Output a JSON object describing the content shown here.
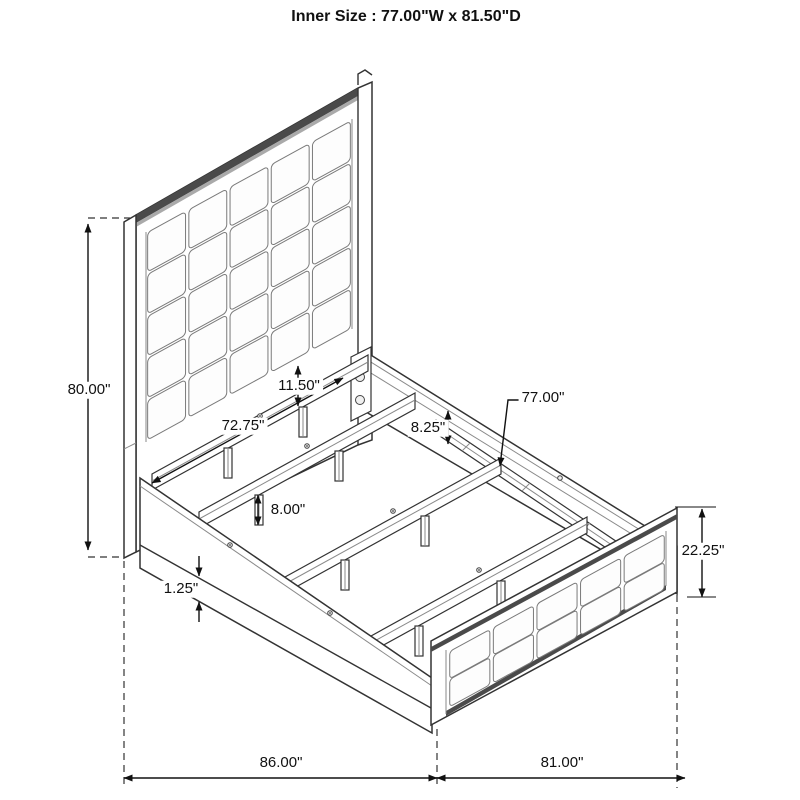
{
  "title": "Inner Size : 77.00\"W x 81.50\"D",
  "dims": {
    "headboard_height": "80.00\"",
    "panel_to_rail_gap": "11.50\"",
    "slat_length": "72.75\"",
    "rail_top_gap": "8.25\"",
    "inner_width": "77.00\"",
    "support_leg_height": "8.00\"",
    "rail_base_trim": "1.25\"",
    "footboard_height": "22.25\"",
    "overall_length": "86.00\"",
    "overall_width": "81.00\""
  },
  "structure": {
    "headboard_tufted_columns": 5,
    "headboard_tufted_rows": 5,
    "footboard_tufted_columns": 5,
    "footboard_tufted_rows": 2
  },
  "colors": {
    "background": "#ffffff",
    "line": "#333333",
    "dimension_line": "#111111",
    "shadow_band": "#4a4a4a"
  }
}
